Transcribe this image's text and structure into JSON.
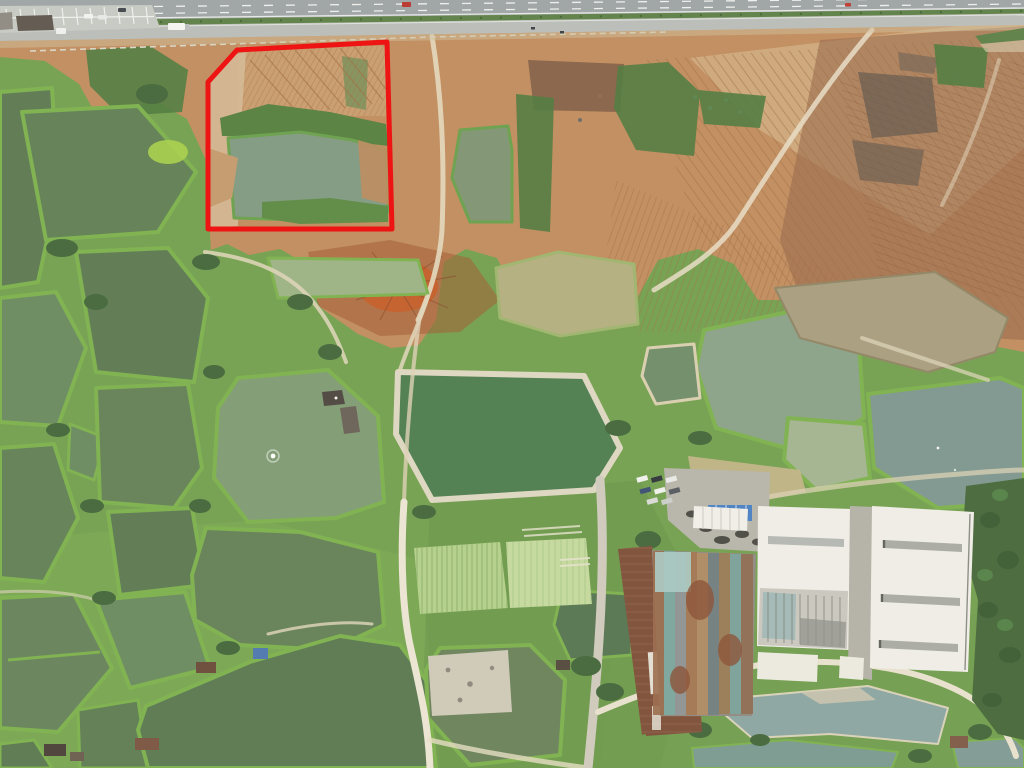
{
  "scene": {
    "type": "aerial-drone-photograph",
    "description": "Top-down drone photo: grid of aquaculture fish ponds and dikes in the lower two thirds, cleared red-earth construction ground along a divided highway at top, factory with rusty roofs and two white warehouses at lower right. A red polygon outline highlights a land parcel (pond plus cleared ground) next to the highway.",
    "width": 1024,
    "height": 768
  },
  "annotation": {
    "name": "parcel-boundary",
    "shape": "polygon",
    "points": "237,50 387,42 392,229 208,229 208,82",
    "color": "#ee1414",
    "stroke_width": 5,
    "fill": "none"
  },
  "palette": {
    "asphalt": "#9ea4a3",
    "service_road": "#babdb7",
    "marking_white": "#eef0ee",
    "median_green": "#5d7f45",
    "dirt_tan": "#c08c5c",
    "dirt_brown": "#97674a",
    "dirt_pale": "#d8bd92",
    "dirt_red_orange": "#c75a24",
    "veg_base": "#74a04e",
    "dike_green": "#7cb04d",
    "tree_green": "#44673a",
    "pond_dark": "#5d7951",
    "pond_mid": "#69875c",
    "pond_sage": "#8aa287",
    "pond_soft_green": "#7f9b72",
    "pond_blue_gray": "#7e968e",
    "pond_pale_sage": "#a3b38e",
    "pond_muddy": "#a89d7d",
    "pond_olive_tan": "#b2ae7e",
    "pond_emerald": "#4e7d4e",
    "pond_bottom_right": "#8ba5a0",
    "sand_path": "#e6dcc1",
    "warehouse_white": "#efede4",
    "factory_rust": "#7d4f38",
    "driveway_gray": "#b3b0a6"
  },
  "features": [
    {
      "name": "divided-highway",
      "note": "dual carriageway with dashed lane lines, top edge"
    },
    {
      "name": "frontage-road",
      "note": "parallel service road below highway"
    },
    {
      "name": "roadside-parking",
      "note": "striped parking bays, top left"
    },
    {
      "name": "earthworks-site",
      "note": "scraped orange/brown earth with grader striations"
    },
    {
      "name": "excavation-mound",
      "note": "bright red-orange spoil heap, center"
    },
    {
      "name": "fish-pond-grid",
      "note": "green ponds separated by vegetated dikes"
    },
    {
      "name": "aerated-pond",
      "note": "pond with white aerator ripple"
    },
    {
      "name": "diked-pond",
      "note": "green pond ringed by pale sand embankment"
    },
    {
      "name": "crop-fields",
      "note": "row-planted vegetable plots"
    },
    {
      "name": "factory-rust-roofs",
      "note": "old sheds with corroded patchwork roofing"
    },
    {
      "name": "white-warehouses",
      "note": "two large white-roofed halls with skylights"
    },
    {
      "name": "tree-belt",
      "note": "dense dark trees along right edge"
    },
    {
      "name": "red-parcel-outline",
      "note": "red boundary annotation near highway"
    }
  ],
  "vehicles": [
    "red-car-on-highway",
    "red-motorcycle-on-highway",
    "dark-car-on-highway",
    "white-truck-on-frontage-road",
    "white-van-on-frontage-road",
    "motorcycles-on-frontage-road",
    "parked-cars-at-parking-bays",
    "parked-vehicles-at-factory-yard"
  ]
}
